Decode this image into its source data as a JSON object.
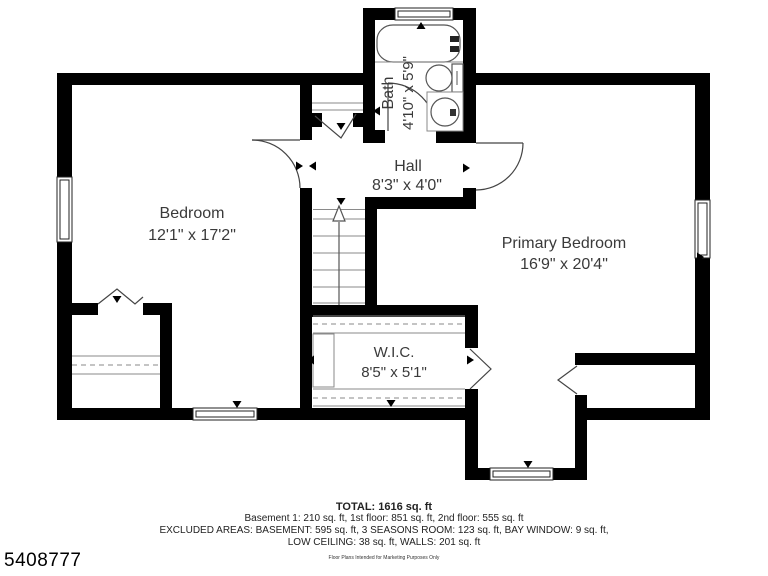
{
  "plan": {
    "rooms": {
      "bedroom": {
        "name": "Bedroom",
        "dims": "12'1\" x 17'2\""
      },
      "hall": {
        "name": "Hall",
        "dims": "8'3\" x 4'0\""
      },
      "bath": {
        "name": "Bath",
        "dims": "4'10\" x 5'9\""
      },
      "primary": {
        "name": "Primary Bedroom",
        "dims": "16'9\" x 20'4\""
      },
      "wic": {
        "name": "W.I.C.",
        "dims": "8'5\" x 5'1\""
      }
    }
  },
  "footer": {
    "total": "TOTAL: 1616 sq. ft",
    "floors": "Basement 1: 210 sq. ft, 1st floor: 851 sq. ft, 2nd floor: 555 sq. ft",
    "excluded1": "EXCLUDED AREAS: BASEMENT: 595 sq. ft, 3 SEASONS ROOM: 123 sq. ft, BAY WINDOW: 9 sq. ft,",
    "excluded2": "LOW CEILING: 38 sq. ft, WALLS: 201 sq. ft",
    "disclaimer": "Floor Plans Intended for Marketing Purposes Only"
  },
  "listing_id": "5408777",
  "colors": {
    "wall": "#000000",
    "fixture_line": "#555555",
    "label_text": "#3a3a3a"
  }
}
